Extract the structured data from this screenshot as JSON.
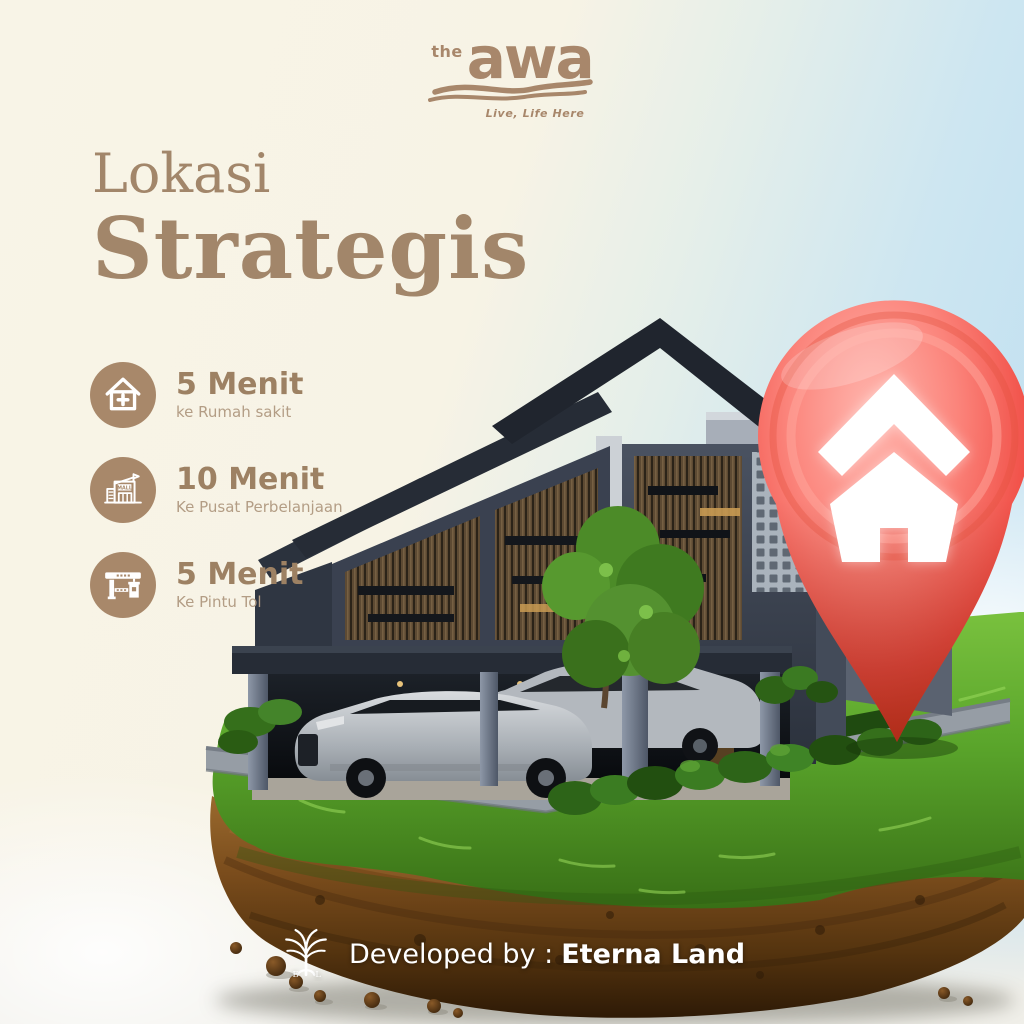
{
  "brand": {
    "prefix": "the",
    "name": "awa",
    "tagline": "Live, Life Here"
  },
  "title": {
    "line1": "Lokasi",
    "line2": "Strategis"
  },
  "features": [
    {
      "icon": "hospital-house-icon",
      "time": "5 Menit",
      "place": "ke Rumah sakit"
    },
    {
      "icon": "mall-icon",
      "time": "10 Menit",
      "place": "Ke Pusat Perbelanjaan",
      "sign_text": "MALL"
    },
    {
      "icon": "toll-gate-icon",
      "time": "5 Menit",
      "place": "Ke Pintu Tol"
    }
  ],
  "footer": {
    "developed_by": "Developed by :",
    "developer": "Eterna Land",
    "logo_monogram_left": "E",
    "logo_monogram_right": "L"
  },
  "colors": {
    "accent_taupe": "#a3876a",
    "pin_red": "#e8452c",
    "grass_green": "#55a42a",
    "soil_brown": "#6e451c",
    "sky_blue": "#bfdff0",
    "cream_background": "#f7f3e6",
    "credit_text": "#ffffff"
  }
}
